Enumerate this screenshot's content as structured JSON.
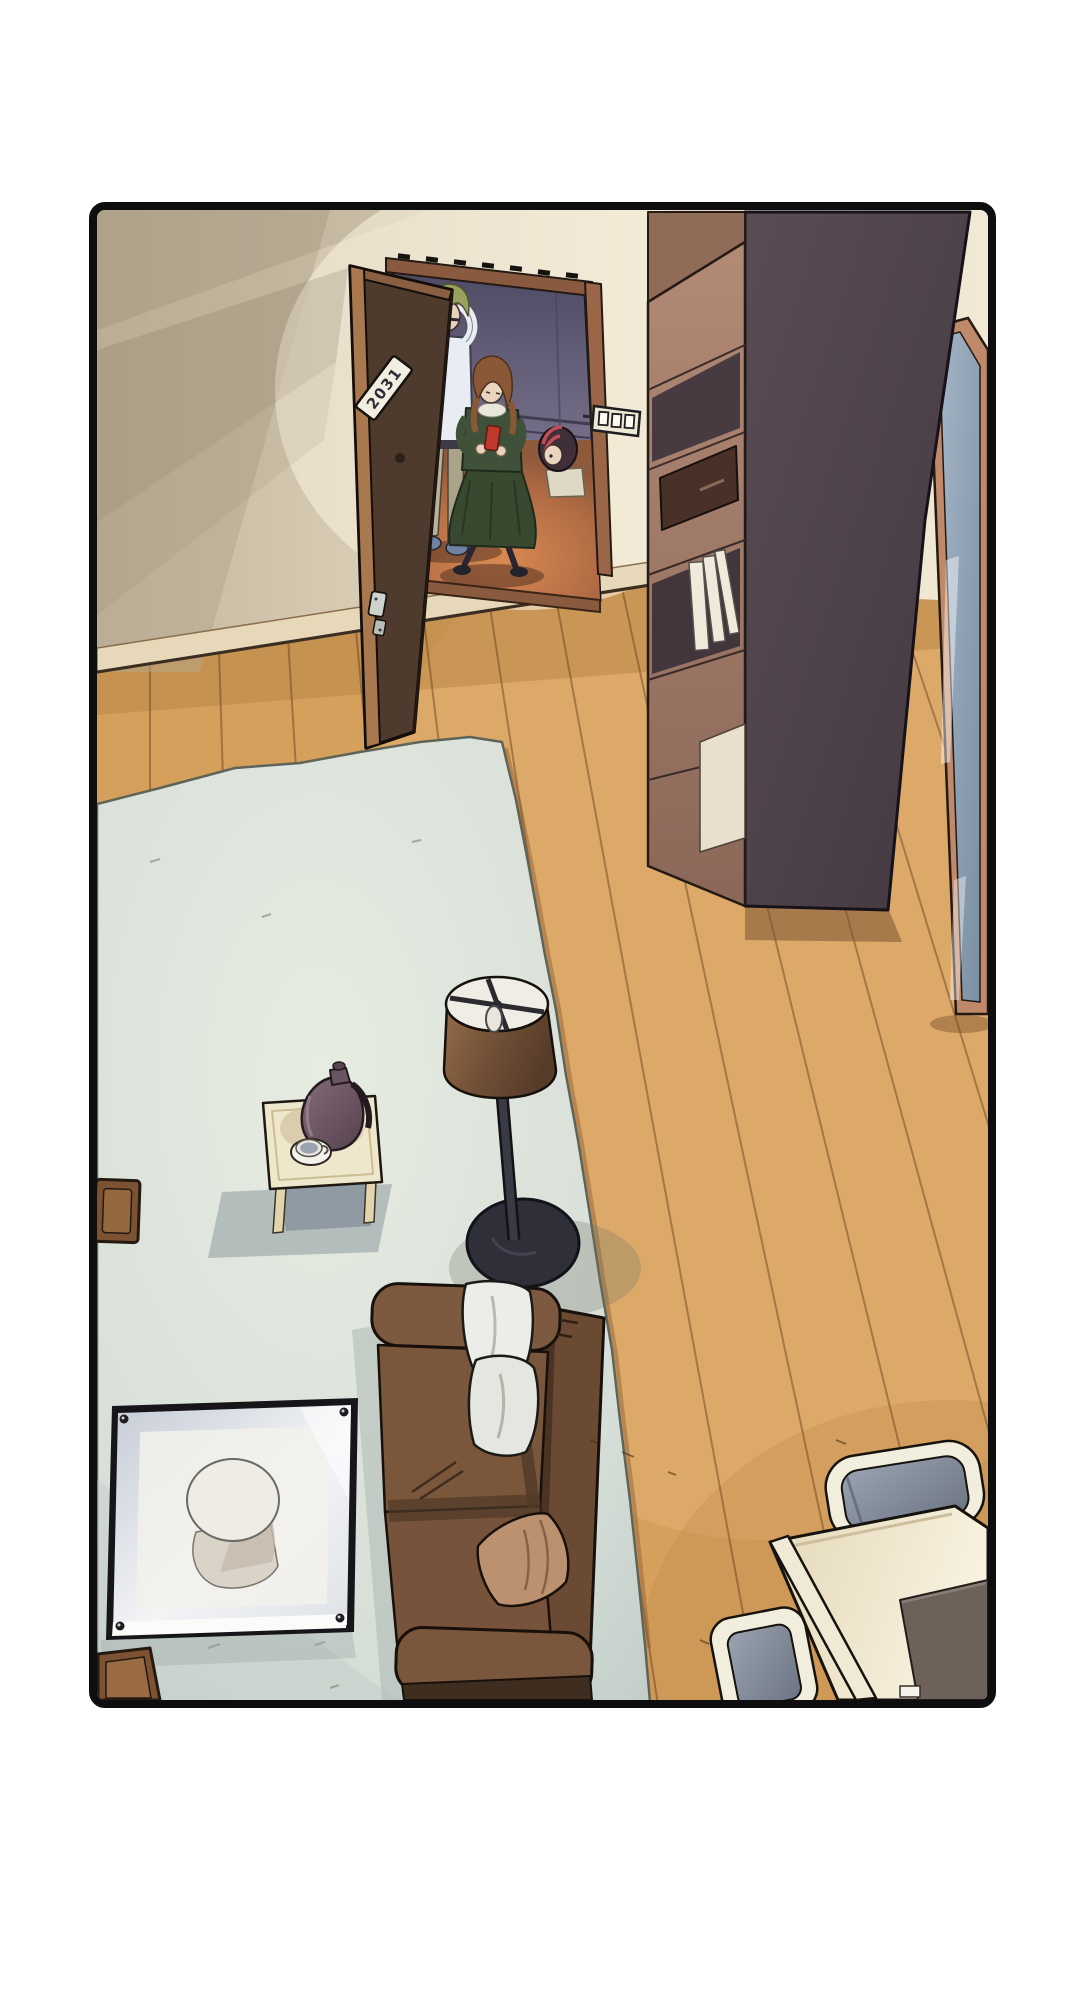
{
  "page": {
    "background": "#ffffff"
  },
  "panel": {
    "kind": "comic-panel",
    "description": "Overhead view of an apartment living room; a man, a woman looking at a red phone, and a child stand at the open front door",
    "border_color": "#0e0e10",
    "door_plate_text": "2031",
    "palette": {
      "wall": "#e7ddc6",
      "floor_wood": "#d5a05c",
      "rug": "#dde4da",
      "hall_wall": "#6e6880",
      "hall_glow": "#c1754a",
      "door_brown": "#503c2e",
      "cabinet_side": "#4e4148",
      "cabinet_face": "#a87f6d",
      "mirror_glass": "#8ba0b5",
      "mirror_frame": "#c08a6a",
      "couch": "#7a563a",
      "pillow_white": "#ecece8",
      "pillow_tan": "#bb9170",
      "lamp_shade": "#7d5a3e",
      "lamp_base": "#2f2f3a",
      "side_table": "#efe7cc",
      "coffee_pot": "#6f5a66",
      "glass_table": "#dfe3e8",
      "dining_table": "#efe5c9",
      "chair_cushion": "#8b93a3",
      "man_hair": "#9aa05e",
      "man_shirt": "#e9edf3",
      "woman_dress": "#3d4d37",
      "woman_hair": "#8a5836",
      "child_hair_accent": "#c44d58",
      "phone_red": "#c0392e"
    },
    "objects": [
      "open-door",
      "door-number-plate",
      "man-at-door",
      "woman-with-phone",
      "child-peeking",
      "light-switch",
      "bookshelf-cabinet",
      "standing-mirror",
      "wood-floor",
      "area-rug",
      "floor-lamp",
      "side-table",
      "coffee-pot",
      "teacup",
      "sofa",
      "white-cushions",
      "tan-cushion",
      "glass-coffee-table",
      "wooden-stool",
      "storage-box",
      "dining-table",
      "dining-chair",
      "placemat"
    ]
  }
}
